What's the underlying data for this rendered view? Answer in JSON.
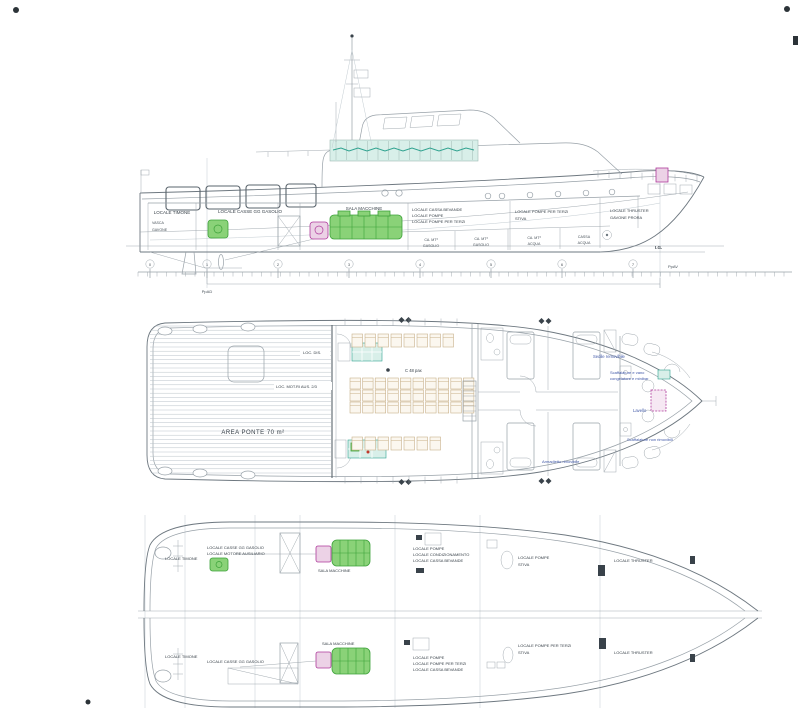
{
  "colors": {
    "paper": "#ffffff",
    "line": "#98a1a8",
    "line_dark": "#6e7880",
    "line_light": "#c3ccd2",
    "text": "#454f57",
    "annotation_blue": "#3f57a7",
    "teal": "#2fa28f",
    "teal_fill": "#d8efe9",
    "engine_green": "#3da23a",
    "engine_green_fill": "#8ad278",
    "gearbox_magenta": "#ae3a9b",
    "gearbox_magenta_fill": "#ecd2e6",
    "seat_tan": "#c9b18a"
  },
  "profile": {
    "compartments": {
      "timone": "LOCALE TIMONE",
      "timone_sub1": "VASCA",
      "timone_sub2": "GAVONE",
      "casse_gasolio": "LOCALE CASSE GG GASOLIO",
      "sala_macchine": "SALA MACCHINE",
      "group1_l1": "LOCALE CASSA BEVANDE",
      "group1_l2": "LOCALE POMPE",
      "group1_l3": "LOCALE POMPE PER TERZI",
      "group2_l1": "LOCALE POMPE PER TERZI",
      "group2_l2": "STIVA",
      "group3_l1": "LOCALE THRUSTER",
      "group3_l2": "GAVONE PRORA"
    },
    "tanks": [
      {
        "l1": "CA. MT³",
        "l2": "GASOLIO"
      },
      {
        "l1": "CA. MT³",
        "l2": "GASOLIO"
      },
      {
        "l1": "CA. MT³",
        "l2": "ACQUA"
      },
      {
        "l1": "CASSA",
        "l2": "ACQUA"
      }
    ],
    "ig_label": "I.G.",
    "ruler": {
      "stations": [
        "0",
        "1",
        "2",
        "3",
        "4",
        "5",
        "6",
        "7"
      ],
      "pp_ad": "PpAD",
      "pp_av": "PpAV"
    }
  },
  "main_deck": {
    "area_ponte": "AREA PONTE 70 m²",
    "loc_dis": "LOC. DIS.",
    "loc_motori": "LOC. MOT.RI AUS. 2/3",
    "seats_label": "C 48 pax",
    "annotations": {
      "sedile": "Sedile removibile",
      "scaffalature1_l1": "Scaffalature e vano",
      "scaffalature1_l2": "congelatore e minibar",
      "lavello": "Lavello",
      "scaffalature2": "Scaffalature non rimovibili",
      "armadietto": "Armadietto rimovibile"
    }
  },
  "lower_deck": {
    "top": {
      "timone": "LOCALE TIMONE",
      "casse_l1": "LOCALE CASSE GG GASOLIO",
      "casse_l2": "LOCALE MOTORE AUSILIARIO",
      "sala": "SALA MACCHINE",
      "pompe_l1": "LOCALE POMPE",
      "pompe_l2": "LOCALE CONDIZIONAMENTO",
      "pompe_l3": "LOCALE CASSA BEVANDE",
      "stiva_l1": "LOCALE POMPE",
      "stiva_l2": "STIVA",
      "thruster": "LOCALE THRUSTER"
    },
    "bottom": {
      "timone": "LOCALE TIMONE",
      "casse": "LOCALE CASSE GG GASOLIO",
      "sala": "SALA MACCHINE",
      "pompe_l1": "LOCALE POMPE",
      "pompe_l2": "LOCALE POMPE PER TERZI",
      "pompe_l3": "LOCALE CASSA BEVANDE",
      "stiva_l1": "LOCALE POMPE PER TERZI",
      "stiva_l2": "STIVA",
      "thruster": "LOCALE THRUSTER"
    }
  }
}
